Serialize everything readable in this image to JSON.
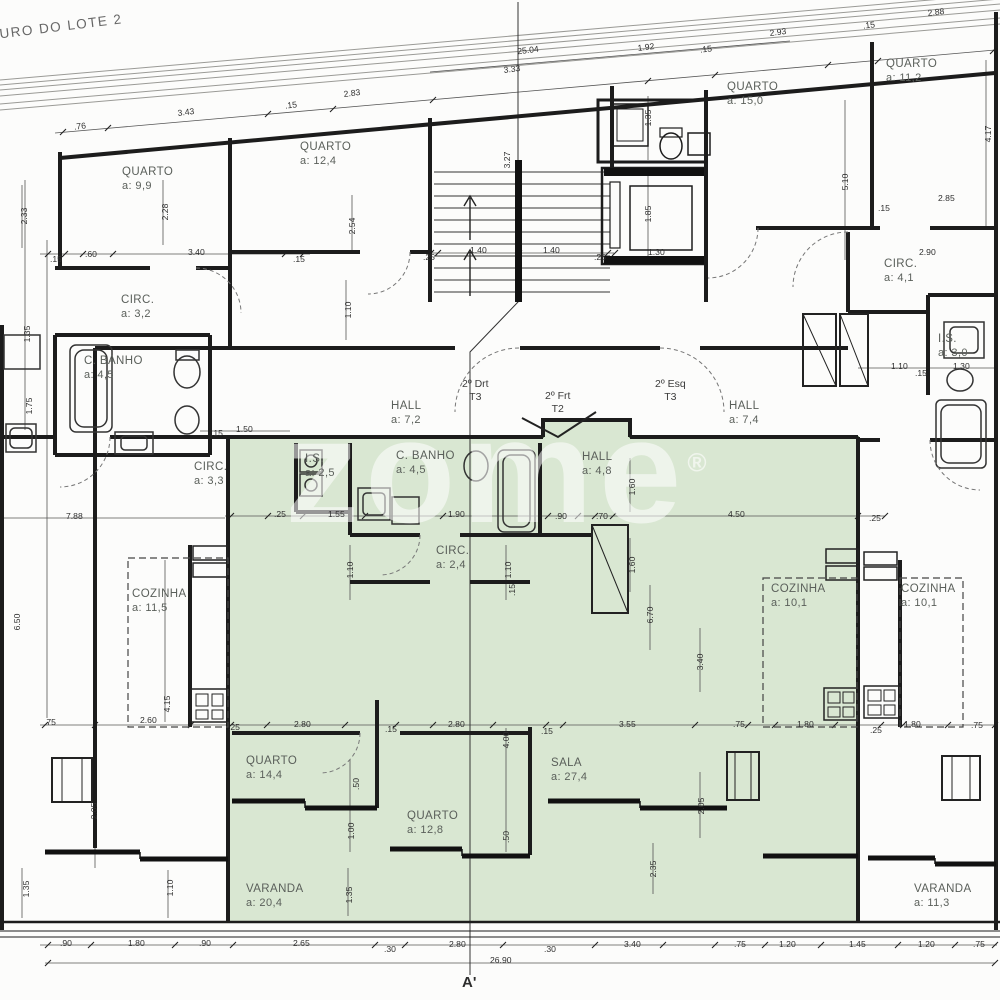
{
  "site": {
    "boundary_label": "MURO DO LOTE 2",
    "section_marker": "A'",
    "overall_width": "26.90"
  },
  "watermark": {
    "text": "zome",
    "registered": "®"
  },
  "colors": {
    "highlight_fill": "#d9e7d2",
    "highlight_stroke": "#6f8f68",
    "wall_line": "#1c1c1c",
    "dim_text": "#2f2f2f"
  },
  "unit_tags": [
    {
      "l1": "2º Drt",
      "l2": "T3",
      "x": 462,
      "y": 378
    },
    {
      "l1": "2º Frt",
      "l2": "T2",
      "x": 545,
      "y": 390
    },
    {
      "l1": "2º Esq",
      "l2": "T3",
      "x": 655,
      "y": 378
    }
  ],
  "rooms": [
    {
      "n": "QUARTO",
      "a": "a: 9,9",
      "x": 122,
      "y": 166
    },
    {
      "n": "QUARTO",
      "a": "a: 12,4",
      "x": 300,
      "y": 141
    },
    {
      "n": "QUARTO",
      "a": "a: 15,0",
      "x": 727,
      "y": 81
    },
    {
      "n": "QUARTO",
      "a": "a: 11,2",
      "x": 886,
      "y": 58
    },
    {
      "n": "CIRC.",
      "a": "a: 3,2",
      "x": 121,
      "y": 294
    },
    {
      "n": "C. BANHO",
      "a": "a: 4,5",
      "x": 84,
      "y": 355
    },
    {
      "n": "CIRC.",
      "a": "a: 3,3",
      "x": 194,
      "y": 461
    },
    {
      "n": "HALL",
      "a": "a: 7,2",
      "x": 391,
      "y": 400
    },
    {
      "n": "HALL",
      "a": "a: 7,4",
      "x": 729,
      "y": 400
    },
    {
      "n": "CIRC.",
      "a": "a: 4,1",
      "x": 884,
      "y": 258
    },
    {
      "n": "I.S.",
      "a": "a: 3,0",
      "x": 938,
      "y": 333
    },
    {
      "n": "I.S.",
      "a": "a: 2,5",
      "x": 305,
      "y": 453
    },
    {
      "n": "C. BANHO",
      "a": "a: 4,5",
      "x": 396,
      "y": 450
    },
    {
      "n": "HALL",
      "a": "a: 4,8",
      "x": 582,
      "y": 451
    },
    {
      "n": "CIRC.",
      "a": "a: 2,4",
      "x": 436,
      "y": 545
    },
    {
      "n": "COZINHA",
      "a": "a: 11,5",
      "x": 132,
      "y": 588
    },
    {
      "n": "COZINHA",
      "a": "a: 10,1",
      "x": 771,
      "y": 583
    },
    {
      "n": "COZINHA",
      "a": "a: 10,1",
      "x": 901,
      "y": 583
    },
    {
      "n": "QUARTO",
      "a": "a: 14,4",
      "x": 246,
      "y": 755
    },
    {
      "n": "QUARTO",
      "a": "a: 12,8",
      "x": 407,
      "y": 810
    },
    {
      "n": "SALA",
      "a": "a: 27,4",
      "x": 551,
      "y": 757
    },
    {
      "n": "VARANDA",
      "a": "a: 20,4",
      "x": 246,
      "y": 883
    },
    {
      "n": "VARANDA",
      "a": "a: 11,3",
      "x": 914,
      "y": 883
    }
  ],
  "dims": [
    {
      "t": ".76",
      "x": 80,
      "y": 126,
      "r": -7
    },
    {
      "t": "3.43",
      "x": 186,
      "y": 112,
      "r": -7
    },
    {
      "t": ".15",
      "x": 291,
      "y": 105,
      "r": -7
    },
    {
      "t": "2.83",
      "x": 352,
      "y": 93,
      "r": -7
    },
    {
      "t": "3.33",
      "x": 512,
      "y": 69,
      "r": -7
    },
    {
      "t": "25.04",
      "x": 528,
      "y": 50,
      "r": -7
    },
    {
      "t": "1.92",
      "x": 646,
      "y": 47,
      "r": -7
    },
    {
      "t": ".15",
      "x": 706,
      "y": 49,
      "r": -7
    },
    {
      "t": "2.93",
      "x": 778,
      "y": 32,
      "r": -7
    },
    {
      "t": ".15",
      "x": 869,
      "y": 25,
      "r": -7
    },
    {
      "t": "2.88",
      "x": 936,
      "y": 12,
      "r": -7
    },
    {
      "t": "2.85",
      "x": 938,
      "y": 198
    },
    {
      "t": ".15",
      "x": 878,
      "y": 208
    },
    {
      "t": "2.90",
      "x": 919,
      "y": 252
    },
    {
      "t": "5.10",
      "x": 845,
      "y": 182,
      "r": -90
    },
    {
      "t": "4.17",
      "x": 988,
      "y": 134,
      "r": -90
    },
    {
      "t": "2.33",
      "x": 24,
      "y": 216,
      "r": -90
    },
    {
      "t": "2.28",
      "x": 165,
      "y": 212,
      "r": -90
    },
    {
      "t": "2.54",
      "x": 352,
      "y": 226,
      "r": -90
    },
    {
      "t": "3.27",
      "x": 507,
      "y": 160,
      "r": -90
    },
    {
      "t": "1.35",
      "x": 648,
      "y": 118,
      "r": -90
    },
    {
      "t": "1.85",
      "x": 648,
      "y": 214,
      "r": -90
    },
    {
      "t": ".25",
      "x": 423,
      "y": 257
    },
    {
      "t": "1.40",
      "x": 470,
      "y": 250
    },
    {
      "t": "1.40",
      "x": 543,
      "y": 250
    },
    {
      "t": ".25",
      "x": 594,
      "y": 257
    },
    {
      "t": "1.30",
      "x": 648,
      "y": 252
    },
    {
      "t": ".15",
      "x": 50,
      "y": 259
    },
    {
      "t": ".60",
      "x": 85,
      "y": 254
    },
    {
      "t": "3.40",
      "x": 188,
      "y": 252
    },
    {
      "t": ".15",
      "x": 293,
      "y": 259
    },
    {
      "t": "1.10",
      "x": 348,
      "y": 310,
      "r": -90
    },
    {
      "t": "1.35",
      "x": 27,
      "y": 334,
      "r": -90
    },
    {
      "t": "1.75",
      "x": 29,
      "y": 406,
      "r": -90
    },
    {
      "t": "1.50",
      "x": 236,
      "y": 429
    },
    {
      "t": ".15",
      "x": 211,
      "y": 433
    },
    {
      "t": "1.10",
      "x": 891,
      "y": 366
    },
    {
      "t": ".15",
      "x": 915,
      "y": 373
    },
    {
      "t": "1.30",
      "x": 953,
      "y": 366
    },
    {
      "t": "7.88",
      "x": 66,
      "y": 516
    },
    {
      "t": ".25",
      "x": 274,
      "y": 514
    },
    {
      "t": "1.55",
      "x": 328,
      "y": 514
    },
    {
      "t": "1.90",
      "x": 448,
      "y": 514
    },
    {
      "t": ".90",
      "x": 555,
      "y": 516
    },
    {
      "t": ".70",
      "x": 596,
      "y": 516
    },
    {
      "t": "4.50",
      "x": 728,
      "y": 514
    },
    {
      "t": ".25",
      "x": 869,
      "y": 518
    },
    {
      "t": "1.10",
      "x": 350,
      "y": 570,
      "r": -90
    },
    {
      "t": "1.10",
      "x": 508,
      "y": 570,
      "r": -90
    },
    {
      "t": ".15",
      "x": 512,
      "y": 590,
      "r": -90
    },
    {
      "t": "1.60",
      "x": 632,
      "y": 487,
      "r": -90
    },
    {
      "t": "1.60",
      "x": 632,
      "y": 565,
      "r": -90
    },
    {
      "t": "6.70",
      "x": 650,
      "y": 615,
      "r": -90
    },
    {
      "t": "3.40",
      "x": 700,
      "y": 662,
      "r": -90
    },
    {
      "t": "6.50",
      "x": 17,
      "y": 622,
      "r": -90
    },
    {
      "t": "4.15",
      "x": 167,
      "y": 704,
      "r": -90
    },
    {
      "t": ".75",
      "x": 44,
      "y": 722
    },
    {
      "t": "2.60",
      "x": 140,
      "y": 720
    },
    {
      "t": ".25",
      "x": 228,
      "y": 727
    },
    {
      "t": "2.80",
      "x": 294,
      "y": 724
    },
    {
      "t": ".15",
      "x": 385,
      "y": 729
    },
    {
      "t": "2.80",
      "x": 448,
      "y": 724
    },
    {
      "t": ".15",
      "x": 541,
      "y": 731
    },
    {
      "t": "3.55",
      "x": 619,
      "y": 724
    },
    {
      "t": ".75",
      "x": 733,
      "y": 724
    },
    {
      "t": "1.80",
      "x": 797,
      "y": 724
    },
    {
      "t": ".25",
      "x": 870,
      "y": 730
    },
    {
      "t": "1.80",
      "x": 904,
      "y": 724
    },
    {
      "t": ".75",
      "x": 971,
      "y": 725
    },
    {
      "t": "4.00",
      "x": 506,
      "y": 740,
      "r": -90
    },
    {
      "t": ".50",
      "x": 356,
      "y": 784,
      "r": -90
    },
    {
      "t": "1.00",
      "x": 351,
      "y": 831,
      "r": -90
    },
    {
      "t": ".50",
      "x": 506,
      "y": 837,
      "r": -90
    },
    {
      "t": "2.05",
      "x": 701,
      "y": 806,
      "r": -90
    },
    {
      "t": "2.05",
      "x": 94,
      "y": 811,
      "r": -90
    },
    {
      "t": "2.35",
      "x": 653,
      "y": 869,
      "r": -90
    },
    {
      "t": "1.35",
      "x": 349,
      "y": 895,
      "r": -90
    },
    {
      "t": "1.35",
      "x": 26,
      "y": 889,
      "r": -90
    },
    {
      "t": "1.10",
      "x": 170,
      "y": 888,
      "r": -90
    },
    {
      "t": ".90",
      "x": 60,
      "y": 943
    },
    {
      "t": "1.80",
      "x": 128,
      "y": 943
    },
    {
      "t": ".90",
      "x": 199,
      "y": 943
    },
    {
      "t": "2.65",
      "x": 293,
      "y": 943
    },
    {
      "t": ".30",
      "x": 384,
      "y": 949
    },
    {
      "t": "2.80",
      "x": 449,
      "y": 944
    },
    {
      "t": ".30",
      "x": 544,
      "y": 949
    },
    {
      "t": "3.40",
      "x": 624,
      "y": 944
    },
    {
      "t": ".75",
      "x": 734,
      "y": 944
    },
    {
      "t": "1.20",
      "x": 779,
      "y": 944
    },
    {
      "t": "1.45",
      "x": 849,
      "y": 944
    },
    {
      "t": "1.20",
      "x": 918,
      "y": 944
    },
    {
      "t": ".75",
      "x": 973,
      "y": 944
    },
    {
      "t": "26.90",
      "x": 490,
      "y": 960
    }
  ]
}
